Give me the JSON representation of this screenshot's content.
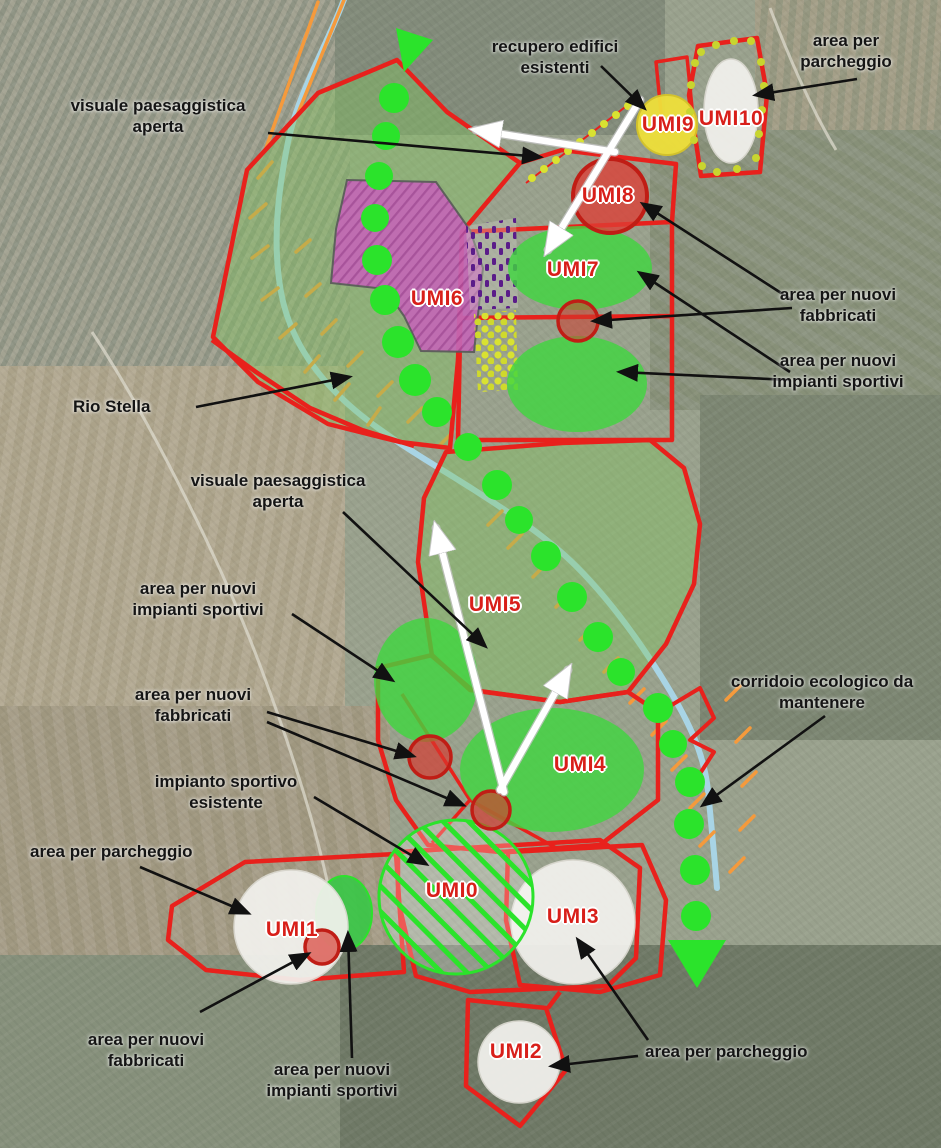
{
  "annotations": {
    "visuale_nord": "visuale paesaggistica aperta",
    "recupero_edifici": "recupero edifici esistenti",
    "parcheggio_nord": "area per parcheggio",
    "rio_stella": "Rio Stella",
    "fabbricati_est": "area per nuovi fabbricati",
    "impianti_est": "area per nuovi impianti sportivi",
    "visuale_centro": "visuale paesaggistica aperta",
    "impianti_ovest": "area per nuovi impianti sportivi",
    "fabbricati_ovest": "area per nuovi fabbricati",
    "impianto_esistente": "impianto sportivo esistente",
    "parcheggio_ovest": "area per parcheggio",
    "corridoio": "corridoio ecologico da mantenere",
    "fabbricati_sud": "area per nuovi fabbricati",
    "impianti_sud": "area per nuovi impianti sportivi",
    "parcheggio_sud": "area per parcheggio"
  },
  "umi_units": {
    "umi0": "UMI0",
    "umi1": "UMI1",
    "umi2": "UMI2",
    "umi3": "UMI3",
    "umi4": "UMI4",
    "umi5": "UMI5",
    "umi6": "UMI6",
    "umi7": "UMI7",
    "umi8": "UMI8",
    "umi9": "UMI9",
    "umi10": "UMI10"
  },
  "colors": {
    "zone_outline_red": "#e8211c",
    "tree_green": "#2be32b",
    "park_green_fill": "rgba(128,198,92,0.4)",
    "sports_green": "#3ed73e",
    "new_building_red": "#d93a30",
    "umi6_magenta": "#c468b6",
    "umi9_yellow": "#efe03a",
    "parking_white": "#f3f2ee",
    "stream_blue": "#a9d7ea",
    "hatch_orange": "#f59a3c",
    "umi_label_red": "#d81f1a",
    "annotation_black": "#151515"
  }
}
